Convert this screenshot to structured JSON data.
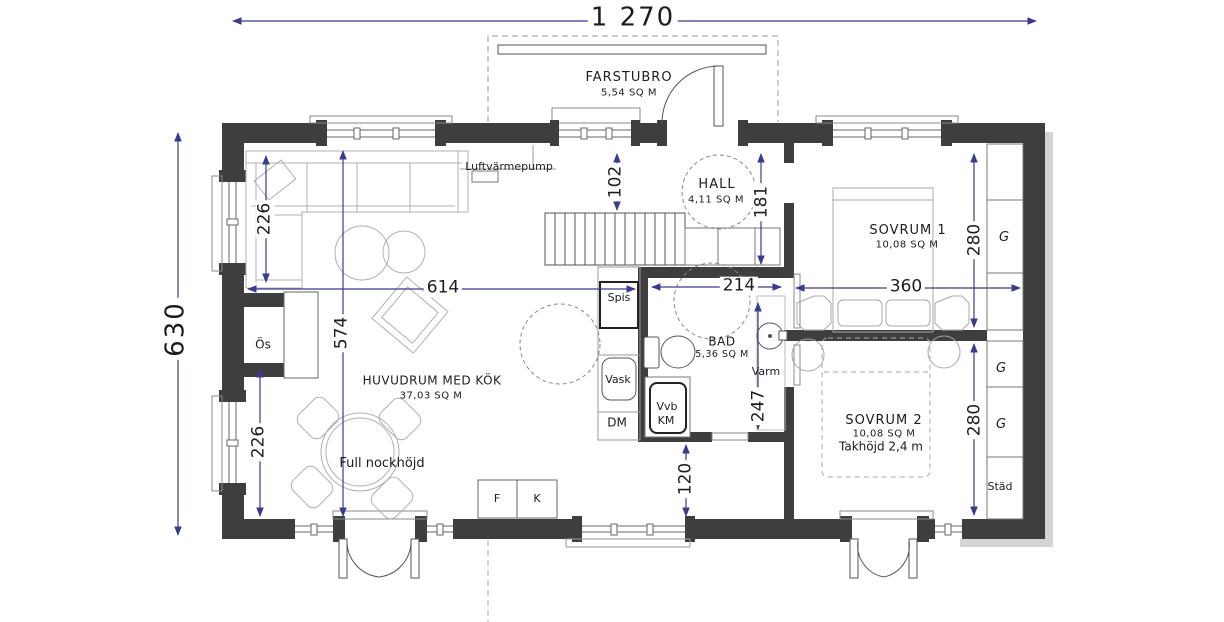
{
  "colors": {
    "wall": "#3e3e3e",
    "dimension": "#3b3b8c",
    "furniture": "#b0b0b0",
    "fixture": "#555555",
    "shadow": "#c6c6c6"
  },
  "overall_dims": {
    "width": "1 270",
    "height": "630"
  },
  "rooms": {
    "farstubro": {
      "name": "FARSTUBRO",
      "area": "5,54 SQ M"
    },
    "hall": {
      "name": "HALL",
      "area": "4,11 SQ M"
    },
    "huvudrum": {
      "name": "HUVUDRUM MED KÖK",
      "area": "37,03 SQ M"
    },
    "bad": {
      "name": "BAD",
      "area": "5,36 SQ M"
    },
    "sovrum1": {
      "name": "SOVRUM 1",
      "area": "10,08 SQ M"
    },
    "sovrum2": {
      "name": "SOVRUM 2",
      "area": "10,08 SQ M",
      "ceiling": "Takhöjd 2,4 m"
    }
  },
  "annotations": {
    "luftvarmepump": "Luftvärmepump",
    "full_nockhojd": "Full nockhöjd"
  },
  "fixtures": {
    "os": "Ös",
    "spis": "Spis",
    "vask": "Vask",
    "dm": "DM",
    "vvb": "Vvb",
    "km": "KM",
    "varm": "Varm",
    "f": "F",
    "k": "K",
    "g1": "G",
    "g2": "G",
    "g3": "G",
    "stad": "Städ"
  },
  "dims": {
    "left_upper": "226",
    "center_vert": "574",
    "left_lower": "226",
    "stair_offset": "102",
    "hall_depth": "181",
    "living_width": "614",
    "bad_width": "214",
    "sovrum1_width": "360",
    "sovrum1_depth": "280",
    "bad_depth": "247",
    "sovrum2_depth": "280",
    "passage": "120"
  }
}
